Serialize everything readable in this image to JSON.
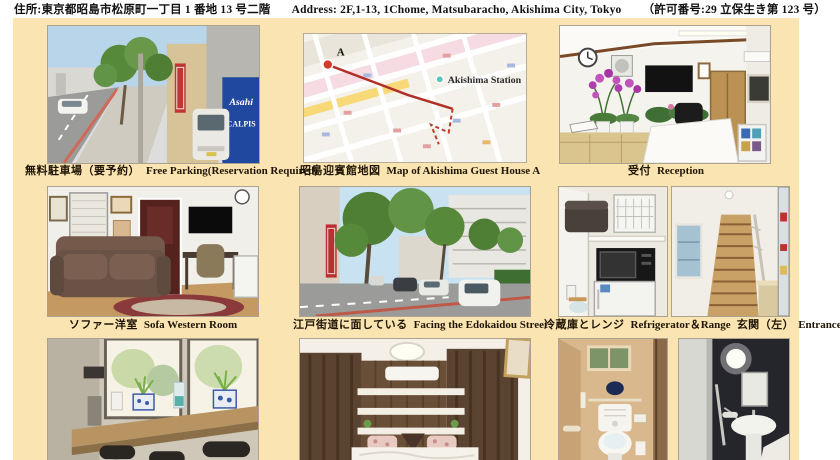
{
  "header": {
    "address_jp": "住所:東京都昭島市松原町一丁目 1 番地 13 号二階",
    "address_en": "Address: 2F,1-13, 1Chome, Matsubaracho, Akishima City, Tokyo",
    "permit": "（許可番号:29 立保生き第 123 号）"
  },
  "captions": {
    "parking_jp": "無料駐車場（要予約）",
    "parking_en": "Free Parking(Reservation Required)",
    "map_jp": "昭島迎賓館地図",
    "map_en": "Map of Akishima Guest House A",
    "reception_jp": "受付",
    "reception_en": "Reception",
    "sofa_jp": "ソファー洋室",
    "sofa_en": "Sofa Western Room",
    "street_jp": "江戸街道に面している",
    "street_en": "Facing the Edokaidou Street",
    "fridge_jp": "冷蔵庫とレンジ",
    "fridge_en": "Refrigerator＆Range",
    "entrance_jp": "玄関（左）",
    "entrance_en": "Entrance (Left Side)"
  },
  "map": {
    "station_label": "Akishima Station",
    "marker_label": "A"
  },
  "photo_text": {
    "asahi": "Asahi",
    "calpis": "CALPIS"
  },
  "colors": {
    "mat_background": "#fae5b2",
    "caption_text": "#201505",
    "route_red": "#b03028",
    "asahi_blue": "#20489e"
  }
}
